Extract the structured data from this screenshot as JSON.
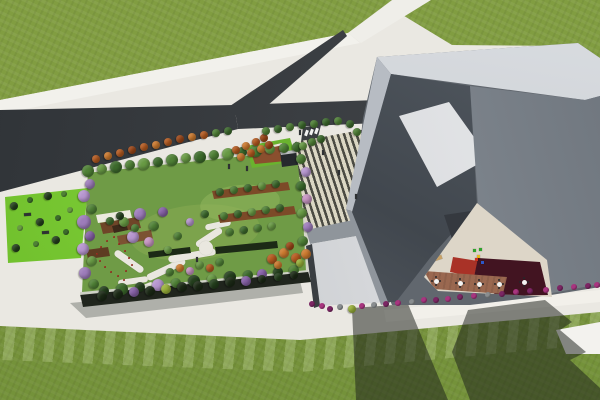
{
  "meta": {
    "title": "Aerial 3D architectural rendering: rooftop garden building, forked road, striped entrance plaza, angular gray buildings with inner courtyard",
    "canvas": {
      "w": 600,
      "h": 400
    }
  },
  "palette": {
    "g1": "#3c6a2c",
    "g2": "#4f8136",
    "g3": "#689a44",
    "g4": "#7cab52",
    "d1": "#243f1d",
    "p1": "#9d7cba",
    "p2": "#b695cf",
    "p3": "#8661a6",
    "pk": "#c795c2",
    "o1": "#b55a1f",
    "o2": "#cd7a2e",
    "o3": "#9c4617",
    "yg": "#9ab23a",
    "m1": "#a8357f",
    "m2": "#7c2664",
    "gr": "#8a8e90",
    "hd": "#1c2a16",
    "rd": "#c03b2a",
    "tan": "#c9a266",
    "wh": "#f2f2f2",
    "dk": "#2e3133",
    "bl": "#2c57c8",
    "ye": "#e6b91e",
    "gn": "#2fa32c",
    "re": "#cc3322"
  },
  "groups": [
    {
      "name": "garden-trees",
      "kind": "circle",
      "item": "tree-icon",
      "items": [
        [
          88,
          171,
          6,
          "g2"
        ],
        [
          102,
          169,
          5,
          "g3"
        ],
        [
          116,
          167,
          6,
          "g1"
        ],
        [
          130,
          165,
          5,
          "g2"
        ],
        [
          144,
          164,
          6,
          "g3"
        ],
        [
          158,
          162,
          5,
          "g1"
        ],
        [
          172,
          160,
          6,
          "g2"
        ],
        [
          186,
          158,
          5,
          "g3"
        ],
        [
          200,
          157,
          6,
          "g1"
        ],
        [
          214,
          155,
          5,
          "g2"
        ],
        [
          228,
          154,
          6,
          "g3"
        ],
        [
          242,
          152,
          5,
          "g1"
        ],
        [
          256,
          151,
          6,
          "g2"
        ],
        [
          270,
          149,
          5,
          "g3"
        ],
        [
          284,
          148,
          5,
          "g2"
        ],
        [
          297,
          147,
          5,
          "g1"
        ],
        [
          90,
          184,
          5,
          "p1"
        ],
        [
          84,
          196,
          6,
          "p2"
        ],
        [
          92,
          209,
          5,
          "g2"
        ],
        [
          84,
          222,
          7,
          "p1"
        ],
        [
          90,
          236,
          5,
          "p3"
        ],
        [
          83,
          249,
          6,
          "p2"
        ],
        [
          92,
          261,
          5,
          "g3"
        ],
        [
          85,
          273,
          6,
          "p1"
        ],
        [
          94,
          284,
          5,
          "g2"
        ],
        [
          104,
          291,
          5,
          "d1"
        ],
        [
          122,
          289,
          6,
          "g1"
        ],
        [
          140,
          287,
          5,
          "d1"
        ],
        [
          158,
          285,
          6,
          "p2"
        ],
        [
          176,
          283,
          5,
          "g2"
        ],
        [
          194,
          281,
          6,
          "d1"
        ],
        [
          212,
          279,
          5,
          "g3"
        ],
        [
          230,
          277,
          6,
          "d1"
        ],
        [
          248,
          275,
          5,
          "g1"
        ],
        [
          262,
          274,
          5,
          "p3"
        ],
        [
          278,
          272,
          5,
          "d1"
        ],
        [
          294,
          270,
          5,
          "g2"
        ],
        [
          301,
          159,
          5,
          "g2"
        ],
        [
          306,
          172,
          5,
          "p2"
        ],
        [
          301,
          186,
          5,
          "g1"
        ],
        [
          307,
          199,
          5,
          "pk"
        ],
        [
          302,
          213,
          5,
          "g3"
        ],
        [
          308,
          227,
          5,
          "p1"
        ],
        [
          303,
          241,
          5,
          "g2"
        ],
        [
          306,
          254,
          5,
          "o2"
        ],
        [
          272,
          259,
          5,
          "o1"
        ],
        [
          284,
          253,
          5,
          "o2"
        ],
        [
          296,
          258,
          5,
          "o1"
        ],
        [
          290,
          246,
          4,
          "o3"
        ],
        [
          278,
          265,
          4,
          "o2"
        ],
        [
          300,
          263,
          4,
          "yg"
        ],
        [
          220,
          192,
          4,
          "g1"
        ],
        [
          234,
          190,
          4,
          "g2"
        ],
        [
          248,
          188,
          4,
          "g1"
        ],
        [
          262,
          186,
          4,
          "g3"
        ],
        [
          276,
          184,
          4,
          "g1"
        ],
        [
          224,
          216,
          4,
          "g2"
        ],
        [
          238,
          214,
          4,
          "g1"
        ],
        [
          252,
          212,
          4,
          "g3"
        ],
        [
          266,
          210,
          4,
          "g2"
        ],
        [
          280,
          208,
          4,
          "g1"
        ],
        [
          230,
          232,
          4,
          "g2"
        ],
        [
          244,
          230,
          4,
          "g1"
        ],
        [
          258,
          228,
          4,
          "g2"
        ],
        [
          272,
          226,
          4,
          "g3"
        ],
        [
          140,
          214,
          6,
          "p1"
        ],
        [
          154,
          226,
          5,
          "g2"
        ],
        [
          133,
          237,
          6,
          "p2"
        ],
        [
          149,
          242,
          5,
          "pk"
        ],
        [
          124,
          222,
          5,
          "g3"
        ],
        [
          163,
          212,
          5,
          "p3"
        ],
        [
          110,
          221,
          4,
          "g1"
        ],
        [
          120,
          216,
          4,
          "d1"
        ],
        [
          135,
          228,
          4,
          "g2"
        ],
        [
          178,
          236,
          4,
          "g2"
        ],
        [
          190,
          222,
          4,
          "p2"
        ],
        [
          205,
          214,
          4,
          "g1"
        ],
        [
          168,
          250,
          4,
          "g3"
        ],
        [
          170,
          272,
          4,
          "g2"
        ],
        [
          180,
          268,
          4,
          "o2"
        ],
        [
          190,
          271,
          4,
          "pk"
        ],
        [
          200,
          265,
          4,
          "g3"
        ],
        [
          210,
          268,
          4,
          "o1"
        ],
        [
          220,
          262,
          4,
          "g2"
        ]
      ]
    },
    {
      "name": "plaza-trees",
      "kind": "circle",
      "item": "tree-icon",
      "items": [
        [
          96,
          159,
          4,
          "o1"
        ],
        [
          108,
          156,
          4,
          "o2"
        ],
        [
          120,
          153,
          4,
          "o1"
        ],
        [
          132,
          150,
          4,
          "o3"
        ],
        [
          144,
          147,
          4,
          "o1"
        ],
        [
          156,
          145,
          4,
          "o2"
        ],
        [
          168,
          142,
          4,
          "o1"
        ],
        [
          180,
          139,
          4,
          "o3"
        ],
        [
          192,
          137,
          4,
          "o2"
        ],
        [
          204,
          135,
          4,
          "o1"
        ],
        [
          236,
          150,
          4,
          "o1"
        ],
        [
          246,
          146,
          4,
          "o2"
        ],
        [
          256,
          142,
          4,
          "o1"
        ],
        [
          264,
          138,
          4,
          "o3"
        ],
        [
          241,
          157,
          4,
          "o2"
        ],
        [
          251,
          153,
          4,
          "o1"
        ],
        [
          261,
          149,
          4,
          "o2"
        ],
        [
          269,
          145,
          4,
          "o3"
        ],
        [
          216,
          133,
          4,
          "g2"
        ],
        [
          228,
          131,
          4,
          "g1"
        ],
        [
          266,
          131,
          4,
          "g2"
        ],
        [
          278,
          129,
          4,
          "g1"
        ],
        [
          290,
          127,
          4,
          "g2"
        ],
        [
          302,
          125,
          4,
          "g1"
        ],
        [
          314,
          124,
          4,
          "g2"
        ],
        [
          326,
          122,
          4,
          "g1"
        ],
        [
          338,
          121,
          4,
          "g2"
        ],
        [
          350,
          124,
          4,
          "g1"
        ],
        [
          357,
          132,
          4,
          "g2"
        ],
        [
          303,
          146,
          4,
          "g3"
        ],
        [
          312,
          142,
          4,
          "g2"
        ],
        [
          321,
          139,
          4,
          "g1"
        ]
      ]
    },
    {
      "name": "left-lawn-bushes",
      "kind": "circle",
      "item": "bush-icon",
      "items": [
        [
          14,
          206,
          4,
          "d1"
        ],
        [
          30,
          200,
          3,
          "g1"
        ],
        [
          48,
          196,
          4,
          "d1"
        ],
        [
          64,
          194,
          3,
          "g2"
        ],
        [
          20,
          228,
          3,
          "g3"
        ],
        [
          40,
          222,
          4,
          "d1"
        ],
        [
          58,
          218,
          3,
          "g1"
        ],
        [
          16,
          248,
          4,
          "d1"
        ],
        [
          36,
          244,
          3,
          "g2"
        ],
        [
          56,
          240,
          4,
          "d1"
        ],
        [
          70,
          210,
          3,
          "g3"
        ],
        [
          66,
          232,
          3,
          "g1"
        ]
      ]
    },
    {
      "name": "facade-hedges",
      "kind": "circle",
      "item": "hedge-icon",
      "items": [
        [
          102,
          296,
          5,
          "hd"
        ],
        [
          118,
          294,
          5,
          "hd"
        ],
        [
          134,
          292,
          5,
          "p3"
        ],
        [
          150,
          291,
          5,
          "hd"
        ],
        [
          166,
          289,
          5,
          "yg"
        ],
        [
          182,
          287,
          5,
          "hd"
        ],
        [
          198,
          286,
          5,
          "hd"
        ],
        [
          214,
          284,
          5,
          "d1"
        ],
        [
          230,
          282,
          5,
          "hd"
        ],
        [
          246,
          281,
          5,
          "p3"
        ],
        [
          262,
          279,
          4,
          "hd"
        ],
        [
          278,
          277,
          4,
          "d1"
        ],
        [
          294,
          275,
          4,
          "hd"
        ]
      ]
    },
    {
      "name": "flower-row",
      "kind": "circle",
      "item": "flower-bush-icon",
      "items": [
        [
          312,
          304,
          3,
          "m2"
        ],
        [
          322,
          306,
          3,
          "m1"
        ],
        [
          330,
          309,
          3,
          "m2"
        ],
        [
          340,
          307,
          3,
          "gr"
        ],
        [
          352,
          309,
          4,
          "yg"
        ],
        [
          362,
          306,
          3,
          "m1"
        ],
        [
          374,
          305,
          3,
          "gr"
        ],
        [
          386,
          304,
          3,
          "m2"
        ],
        [
          398,
          303,
          3,
          "m1"
        ],
        [
          412,
          302,
          3,
          "gr"
        ],
        [
          424,
          300,
          3,
          "m1"
        ],
        [
          436,
          300,
          3,
          "m2"
        ],
        [
          448,
          299,
          3,
          "m1"
        ],
        [
          460,
          297,
          3,
          "m2"
        ],
        [
          474,
          296,
          3,
          "m1"
        ],
        [
          488,
          295,
          3,
          "gr"
        ],
        [
          502,
          294,
          3,
          "m2"
        ],
        [
          516,
          292,
          3,
          "m1"
        ],
        [
          530,
          291,
          3,
          "m2"
        ],
        [
          546,
          290,
          3,
          "m1"
        ],
        [
          560,
          288,
          3,
          "m2"
        ],
        [
          574,
          287,
          3,
          "m1"
        ],
        [
          588,
          286,
          3,
          "m2"
        ],
        [
          597,
          285,
          3,
          "m1"
        ]
      ]
    },
    {
      "name": "red-flower-bed",
      "kind": "dot",
      "item": "flower-dot-icon",
      "size": 2,
      "color": "rd",
      "zone": "garden",
      "items": [
        [
          96,
          253
        ],
        [
          100,
          246
        ],
        [
          106,
          240
        ],
        [
          113,
          236
        ],
        [
          99,
          260
        ],
        [
          104,
          266
        ],
        [
          110,
          271
        ],
        [
          117,
          275
        ],
        [
          123,
          279
        ],
        [
          118,
          243
        ],
        [
          124,
          250
        ],
        [
          128,
          257
        ],
        [
          131,
          264
        ],
        [
          125,
          270
        ]
      ]
    },
    {
      "name": "playground-equipment",
      "kind": "rect",
      "item": "playground-icon",
      "zone": "courtyard",
      "items": [
        [
          473,
          249,
          3,
          3,
          "gn",
          0
        ],
        [
          477,
          255,
          3,
          3,
          "ye",
          0
        ],
        [
          481,
          261,
          3,
          3,
          "bl",
          0
        ],
        [
          475,
          258,
          3,
          3,
          "re",
          0
        ],
        [
          479,
          248,
          3,
          3,
          "gn",
          0
        ]
      ]
    },
    {
      "name": "loungers",
      "kind": "rect",
      "item": "lounger-icon",
      "zone": "courtyard",
      "items": [
        [
          426,
          259,
          8,
          4,
          "tan",
          -18
        ],
        [
          434,
          256,
          8,
          4,
          "tan",
          -18
        ]
      ]
    },
    {
      "name": "benches",
      "kind": "rect",
      "item": "bench-icon",
      "items": [
        [
          24,
          213,
          7,
          3,
          "dk",
          -4
        ],
        [
          42,
          231,
          7,
          3,
          "dk",
          -4
        ]
      ]
    },
    {
      "name": "crosswalk",
      "kind": "rect",
      "item": "crosswalk-stripe",
      "items": [
        [
          305,
          130,
          3,
          6,
          "wh",
          20
        ],
        [
          310,
          129,
          3,
          6,
          "wh",
          20
        ],
        [
          315,
          128,
          3,
          6,
          "wh",
          20
        ]
      ]
    },
    {
      "name": "pedestrians",
      "kind": "rect",
      "item": "person-figure",
      "items": [
        [
          228,
          164,
          2,
          5,
          "dk",
          0
        ],
        [
          246,
          166,
          2,
          5,
          "dk",
          0
        ],
        [
          322,
          150,
          2,
          5,
          "dk",
          0
        ],
        [
          338,
          170,
          2,
          5,
          "dk",
          0
        ],
        [
          355,
          194,
          2,
          5,
          "dk",
          0
        ],
        [
          299,
          130,
          2,
          5,
          "dk",
          0
        ],
        [
          196,
          257,
          2,
          5,
          "dk",
          0
        ]
      ]
    },
    {
      "name": "cafe-tables",
      "kind": "table",
      "item": "cafe-table-icon",
      "zone": "courtyard",
      "items": [
        [
          436,
          281
        ],
        [
          460,
          283
        ],
        [
          479,
          284
        ],
        [
          499,
          284
        ],
        [
          524,
          282
        ]
      ]
    }
  ]
}
